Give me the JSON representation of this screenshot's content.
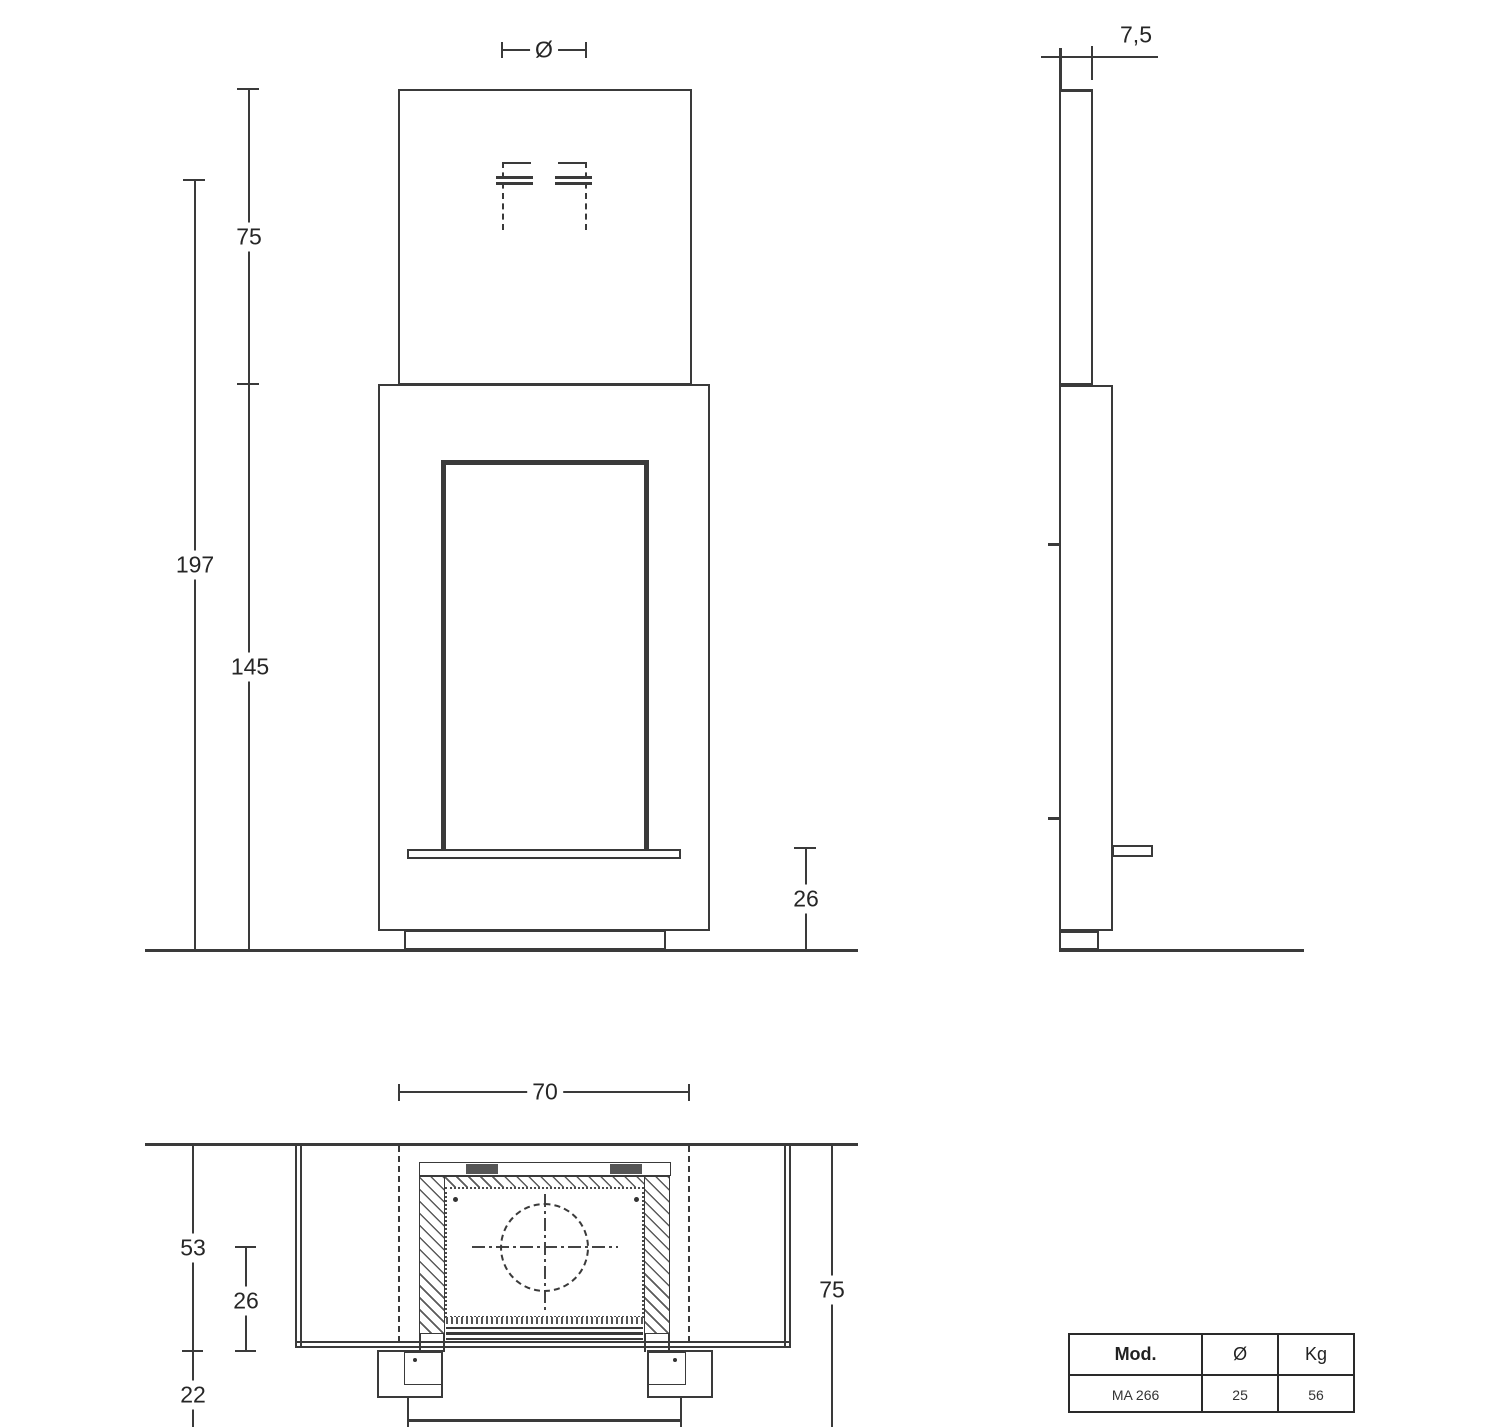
{
  "dimensions": {
    "front": {
      "diameter": "Ø",
      "chimney_height": "75",
      "flue_outlet_height": "197",
      "body_height": "145",
      "hearth_height": "26"
    },
    "side": {
      "panel_thickness": "7,5"
    },
    "plan": {
      "width": "70",
      "depth_total": "53",
      "depth_firebox": "26",
      "front_offset": "22",
      "side_depth": "75"
    }
  },
  "spec_table": {
    "headers": [
      "Mod.",
      "Ø",
      "Kg"
    ],
    "rows": [
      [
        "MA 266",
        "25",
        "56"
      ]
    ]
  },
  "colors": {
    "line": "#3a3a3a",
    "background": "#ffffff"
  }
}
